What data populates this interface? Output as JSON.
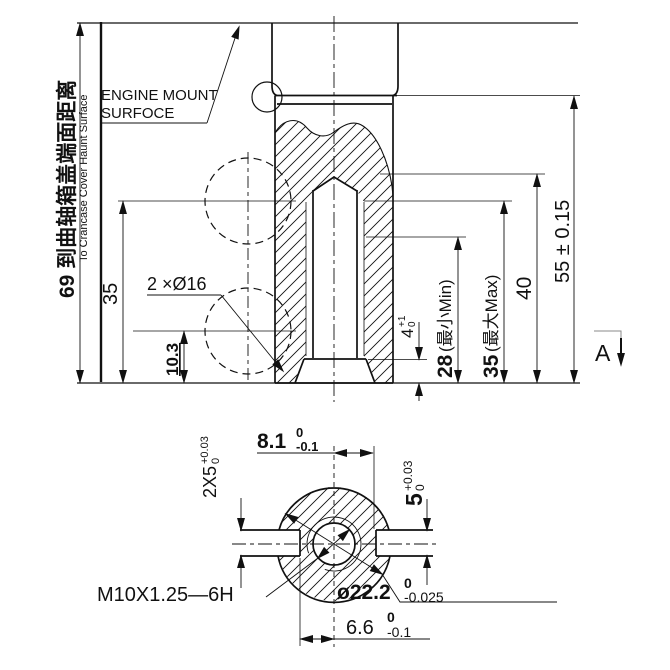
{
  "colors": {
    "ink": "#111111",
    "background": "#ffffff"
  },
  "labels": {
    "engine_mount_line1": "ENGINE MOUNT",
    "engine_mount_line2": "SURFOCE",
    "section_marker": "A",
    "thread_callout": "M10X1.25—6H",
    "holes_callout": "2 ×Ø16"
  },
  "front_view": {
    "dist_value_cn": "69 到曲轴箱盖端面距离",
    "dist_en": "To Crancase Cover Haunt Surface",
    "dim_35": "35",
    "dim_103": "10.3",
    "dim_55": "55 ± 0.15",
    "dim_40": "40",
    "dim_35max_value": "35",
    "dim_35max_suffix": "(最大Max)",
    "dim_28min_value": "28",
    "dim_28min_suffix": "(最小Min)",
    "dim_4_value": "4",
    "dim_4_tol_up": "+1",
    "dim_4_tol_dn": "0"
  },
  "bottom_view": {
    "dim_81_value": "8.1",
    "dim_81_tol_up": "0",
    "dim_81_tol_dn": "-0.1",
    "dim_2x5_value": "2X5",
    "dim_2x5_tol_up": "+0.03",
    "dim_2x5_tol_dn": "0",
    "dim_5_value": "5",
    "dim_5_tol_up": "+0.03",
    "dim_5_tol_dn": "0",
    "dim_66_value": "6.6",
    "dim_66_tol_up": "0",
    "dim_66_tol_dn": "-0.1",
    "dim_222_value": "ø22.2",
    "dim_222_tol_up": "0",
    "dim_222_tol_dn": "-0.025"
  }
}
